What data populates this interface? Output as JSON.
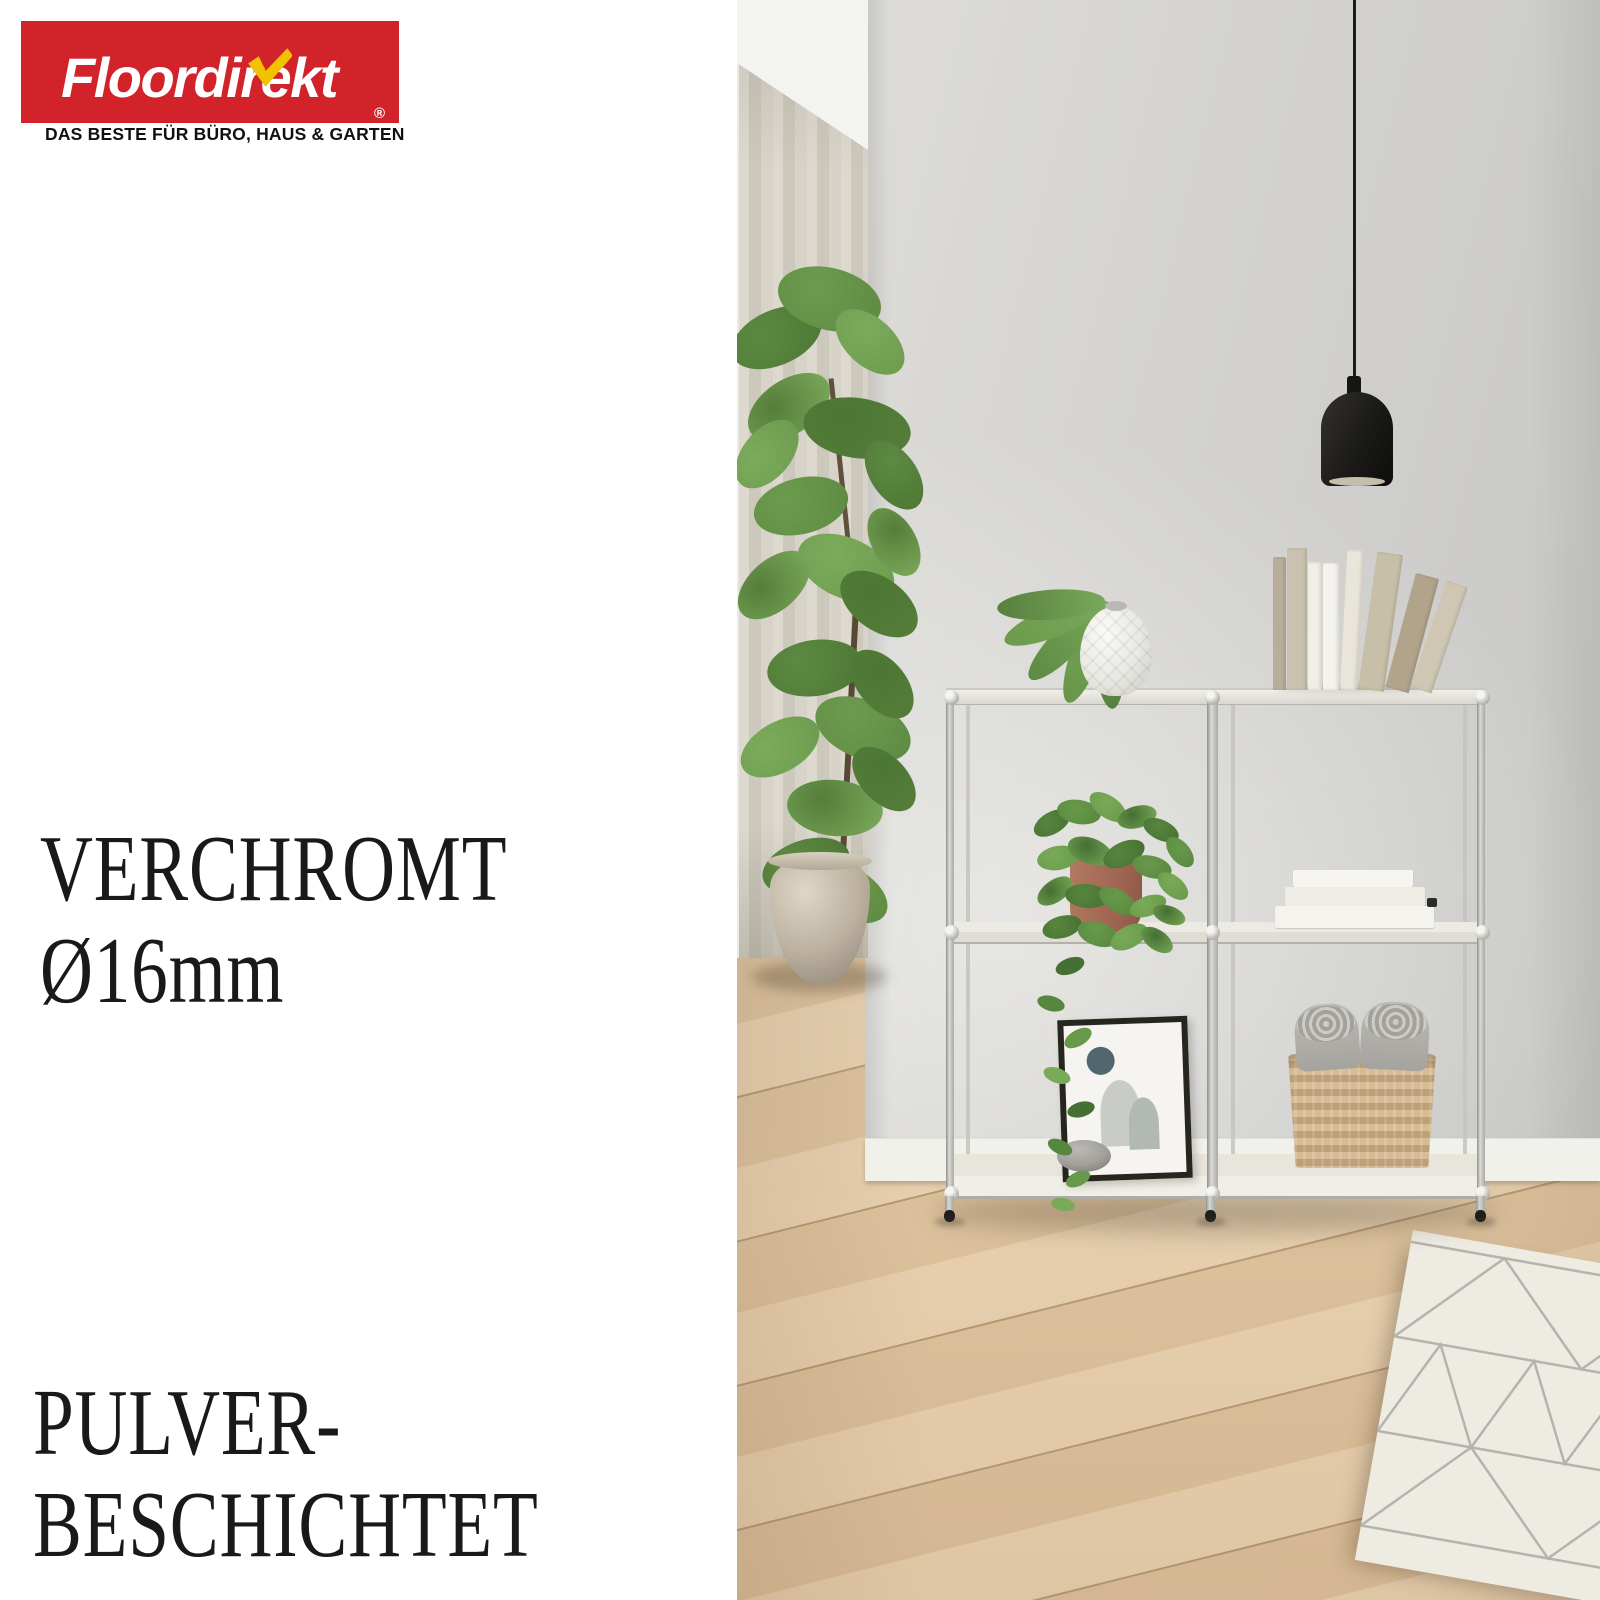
{
  "brand": {
    "logo_text": "Floordirekt",
    "registered_mark": "®",
    "tagline": "DAS BESTE FÜR BÜRO, HAUS & GARTEN"
  },
  "claims": {
    "chrome_title": "VERCHROMT",
    "chrome_subtitle": "Ø16mm",
    "powder_line1": "PULVER-",
    "powder_line2": "BESCHICHTET"
  },
  "theme": {
    "logo_red": "#d2232a",
    "logo_white": "#ffffff",
    "check_yellow": "#f2c200",
    "text_black": "#191919",
    "wall": "#d2d1cf",
    "nook": "#eceae4",
    "ceiling": "#f3f3ef",
    "curtain": "#d5d1c6",
    "floor_wood": "#dfc6a6",
    "baseboard": "#f1f1ec",
    "metal_chrome": "#c2c1bc",
    "shelf_board": "#e9e7df",
    "lamp_black": "#1b1a18",
    "lamp_glow": "#d9d0bd",
    "terracotta": "#a56a54",
    "leaf_green": "#5d8a42",
    "basket_weave": "#ccb189",
    "towel_gray": "#b7b5b0",
    "rug": "#edebe2",
    "rug_line": "#a7a6a1",
    "stone_gray": "#a8a7a2",
    "frame_black": "#26261f",
    "vase_white": "#f0efeb"
  },
  "scene": {
    "objects": [
      {
        "name": "pendant-lamp",
        "color": "#1b1a18"
      },
      {
        "name": "sheer-curtain",
        "color": "#d5d1c6"
      },
      {
        "name": "fiddle-leaf-fig-plant",
        "color": "#5d8a42"
      },
      {
        "name": "ceramic-floor-pot",
        "color": "#bcb19f"
      },
      {
        "name": "chrome-shelving-unit",
        "color": "#c2c1bc"
      },
      {
        "name": "faceted-white-vase-with-monstera-leaf",
        "color": "#f0efeb"
      },
      {
        "name": "trailing-pothos-in-terracotta-pot",
        "color": "#a56a54"
      },
      {
        "name": "white-book-stack",
        "color": "#f4f3ee"
      },
      {
        "name": "framed-abstract-print",
        "color": "#26261f"
      },
      {
        "name": "pebble-stone",
        "color": "#a8a7a2"
      },
      {
        "name": "woven-rope-basket-with-towels",
        "color": "#ccb189"
      },
      {
        "name": "oak-plank-floor",
        "color": "#dfc6a6"
      },
      {
        "name": "white-pattern-rug",
        "color": "#edebe2"
      }
    ],
    "shelf": {
      "top_books": [
        {
          "color": "#b9ae99",
          "w": 13,
          "h": 133,
          "lean": 0
        },
        {
          "color": "#cac2af",
          "w": 20,
          "h": 142,
          "lean": 0
        },
        {
          "color": "#f0eee7",
          "w": 14,
          "h": 128,
          "lean": 0
        },
        {
          "color": "#f5f3ed",
          "w": 16,
          "h": 127,
          "lean": 0
        },
        {
          "color": "#e9e5da",
          "w": 17,
          "h": 140,
          "lean": 3
        },
        {
          "color": "#c8bfa9",
          "w": 26,
          "h": 138,
          "lean": 8
        },
        {
          "color": "#b1a48b",
          "w": 24,
          "h": 118,
          "lean": 15
        },
        {
          "color": "#cfc7b4",
          "w": 22,
          "h": 112,
          "lean": 19
        }
      ],
      "stacked_books": [
        {
          "color": "#f6f5f1",
          "x": 556,
          "y": 870,
          "w": 120,
          "h": 17
        },
        {
          "color": "#efece6",
          "x": 548,
          "y": 887,
          "w": 140,
          "h": 19
        },
        {
          "color": "#f4f3ee",
          "x": 538,
          "y": 906,
          "w": 159,
          "h": 22
        }
      ]
    }
  }
}
